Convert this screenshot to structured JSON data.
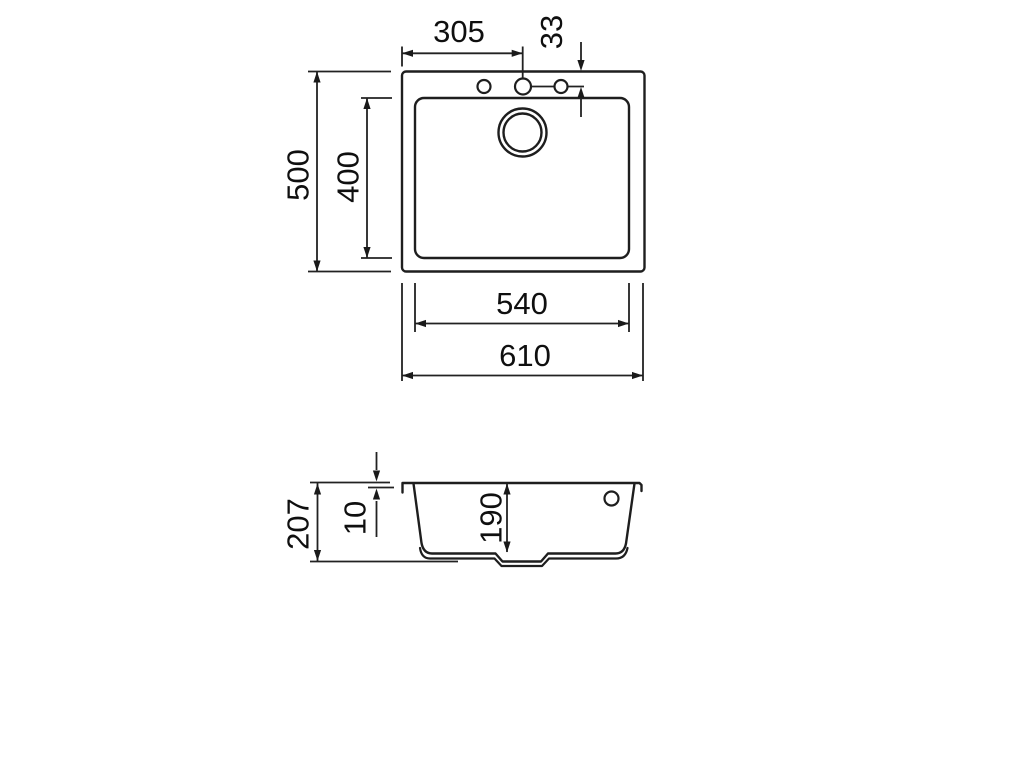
{
  "colors": {
    "background": "#ffffff",
    "line": "#1e1e1e",
    "dimension_line": "#222222",
    "text": "#0f0f0f"
  },
  "views": {
    "plan": {
      "dims": {
        "tap_hole_from_left_edge": "305",
        "tap_hole_from_top_edge": "33",
        "overall_front_to_back": "500",
        "bowl_front_to_back": "400",
        "bowl_width": "540",
        "overall_width": "610"
      }
    },
    "section": {
      "dims": {
        "overall_height": "207",
        "rim_height": "10",
        "bowl_depth": "190"
      }
    }
  }
}
